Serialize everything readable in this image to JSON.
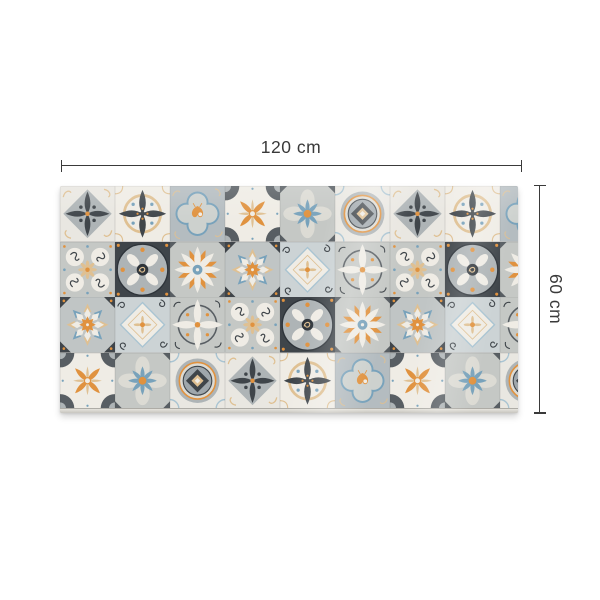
{
  "page": {
    "background_color": "#ffffff"
  },
  "product_image": {
    "description": "patchwork azulejos tile vinyl rug with dimension annotations",
    "width_dimension": {
      "label": "120 cm"
    },
    "height_dimension": {
      "label": "60 cm"
    },
    "annotation_color": "#3a3a3a"
  },
  "rug": {
    "palette": {
      "bg_light": "#e9e7e1",
      "bg_grey": "#c5c8c5",
      "bg_bluegrey": "#b4bcc0",
      "bg_bluegrey2": "#c0c5c5",
      "white_warm": "#efece5",
      "pale": "#dcdbd4",
      "grey_mid": "#aeb4b6",
      "grey_blue2": "#9fa7ac",
      "dark": "#3f454a",
      "dark_soft": "#585e63",
      "dark2": "#2e343a",
      "blue": "#78a2bb",
      "blue_light": "#a9c4d2",
      "blue_pale": "#ccd3d5",
      "orange": "#e0923f",
      "tan": "#dfc092",
      "seam": "#cfcecc"
    },
    "tile_names": {
      "A": "compass-star-tile",
      "B": "petal-ring-tile",
      "C": "quatrefoil-tile",
      "D": "corner-fan-tile",
      "E": "blue-daisy-tile",
      "F": "target-medallion-tile",
      "G": "scroll-circles-tile",
      "H": "ring-medallion-tile",
      "I": "star-flower-tile",
      "J": "geo-star-tile",
      "K": "diamond-tile",
      "L": "petal-circle-tile"
    },
    "grid": {
      "rows": 4,
      "cols": 9,
      "layout": [
        [
          "A",
          "B",
          "C",
          "D",
          "E",
          "F",
          "A",
          "B",
          "C"
        ],
        [
          "G",
          "H",
          "I",
          "J",
          "K",
          "L",
          "G",
          "H",
          "I"
        ],
        [
          "J",
          "K",
          "L",
          "G",
          "H",
          "I",
          "J",
          "K",
          "L"
        ],
        [
          "D",
          "E",
          "F",
          "A",
          "B",
          "C",
          "D",
          "E",
          "F"
        ]
      ]
    }
  }
}
